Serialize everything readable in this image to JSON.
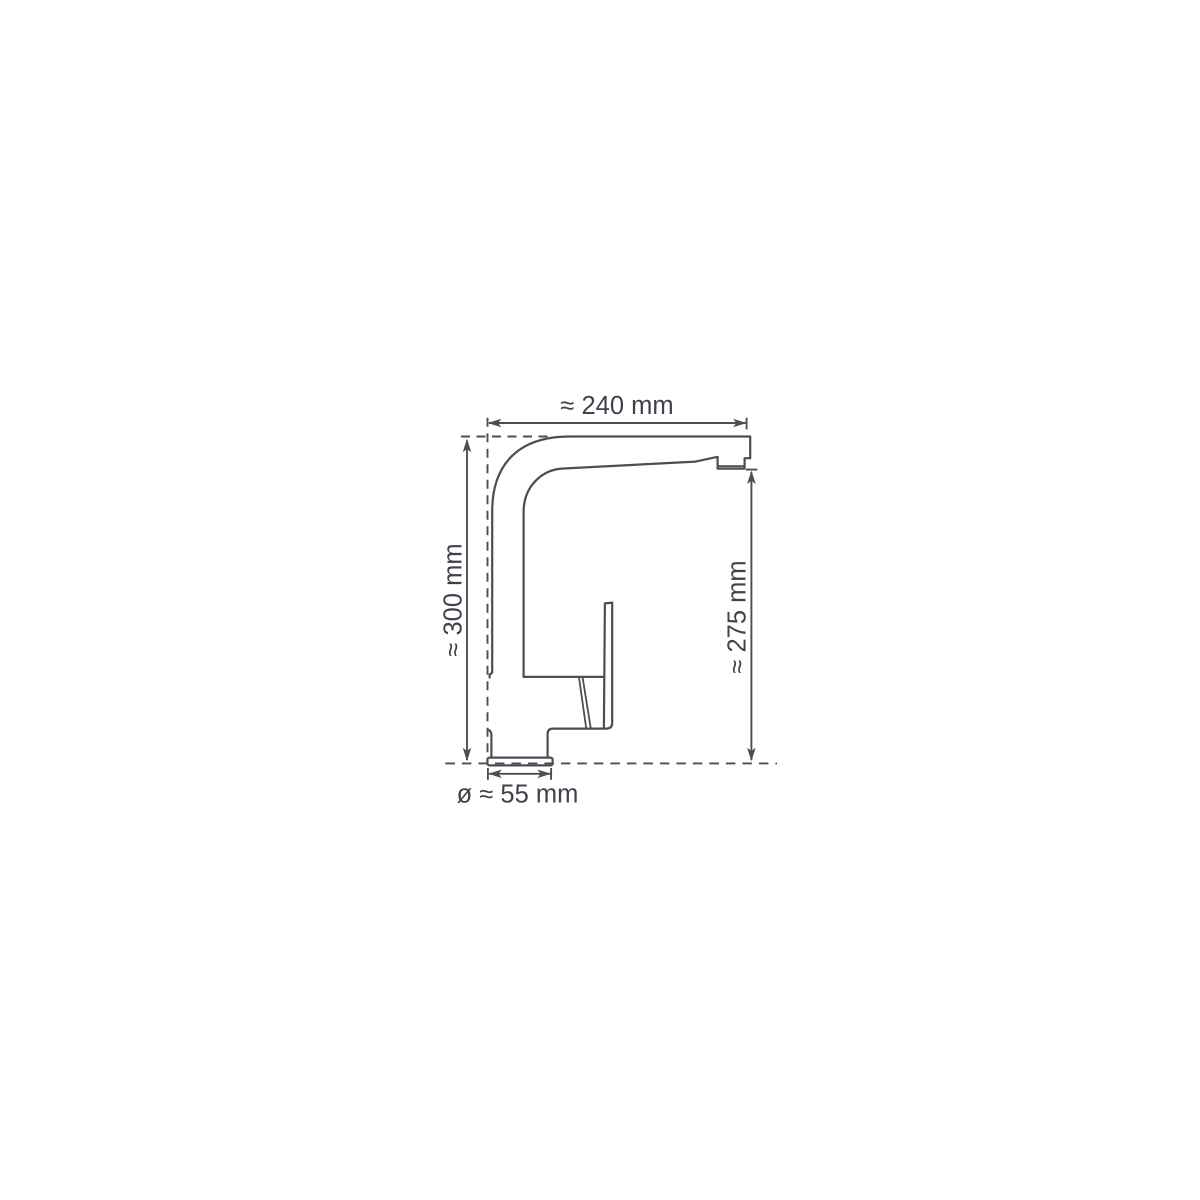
{
  "diagram": {
    "type": "technical-dimension-drawing",
    "subject": "kitchen-faucet-side-view",
    "unit": "mm",
    "labels": {
      "spout_reach": "≈ 240 mm",
      "total_height": "≈ 300 mm",
      "outlet_height": "≈ 275 mm",
      "base_diameter": "ø ≈ 55 mm"
    },
    "colors": {
      "line": "#4a4f55",
      "text": "#3e434b",
      "background": "#ffffff"
    }
  }
}
